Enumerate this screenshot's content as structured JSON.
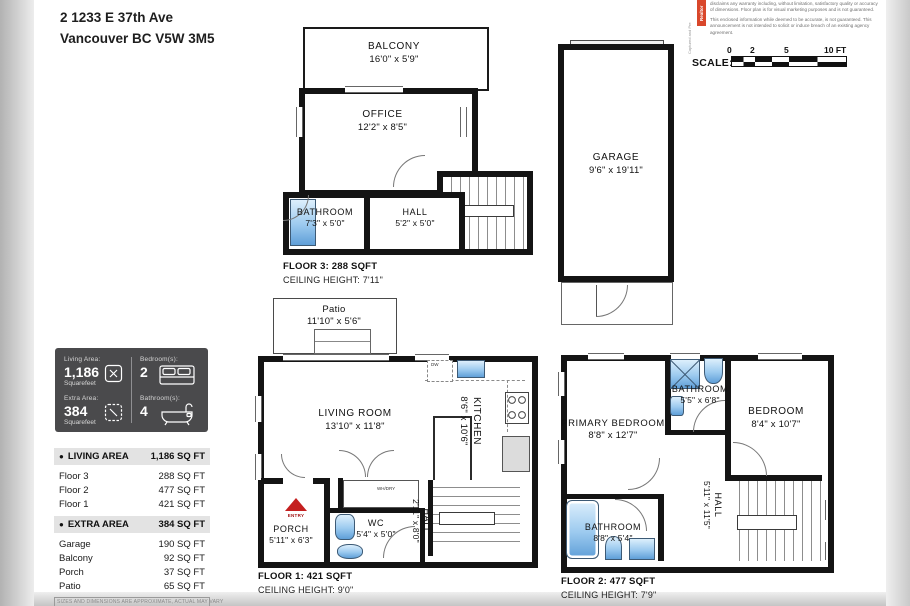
{
  "address": {
    "line1": "2 1233 E 37th Ave",
    "line2": "Vancouver BC V5W 3M5"
  },
  "branding": {
    "side_caption": "Captured and Pre",
    "badge": "Realtor"
  },
  "disclaimer": {
    "p1": "disclaims any warranty including, without limitation, satisfactory quality or accuracy of dimensions. Floor plan is for visual marketing purposes and is not guaranteed.",
    "p2": "This enclosed information while deemed to be accurate, is not guaranteed. This announcement is not intended to solicit or induce breach of an existing agency agreement."
  },
  "scale": {
    "label": "SCALE:",
    "t0": "0",
    "t2": "2",
    "t5": "5",
    "t10": "10 FT"
  },
  "stats": {
    "living": {
      "label": "Living Area:",
      "value": "1,186",
      "unit": "Squarefeet"
    },
    "extra": {
      "label": "Extra Area:",
      "value": "384",
      "unit": "Squarefeet"
    },
    "bedrooms": {
      "label": "Bedroom(s):",
      "value": "2"
    },
    "bathrooms": {
      "label": "Bathroom(s):",
      "value": "4"
    }
  },
  "area_table": {
    "living": {
      "title": "LIVING AREA",
      "total": "1,186 SQ FT",
      "rows": [
        {
          "label": "Floor 3",
          "value": "288 SQ FT"
        },
        {
          "label": "Floor 2",
          "value": "477 SQ FT"
        },
        {
          "label": "Floor 1",
          "value": "421 SQ FT"
        }
      ]
    },
    "extra": {
      "title": "EXTRA AREA",
      "total": "384 SQ FT",
      "rows": [
        {
          "label": "Garage",
          "value": "190 SQ FT"
        },
        {
          "label": "Balcony",
          "value": "92 SQ FT"
        },
        {
          "label": "Porch",
          "value": "37 SQ FT"
        },
        {
          "label": "Patio",
          "value": "65 SQ FT"
        }
      ]
    },
    "footnote": "SIZES AND DIMENSIONS ARE APPROXIMATE, ACTUAL MAY VARY"
  },
  "floor3": {
    "caption": "FLOOR 3: 288 SQFT",
    "ceiling": "CEILING HEIGHT: 7'11\"",
    "balcony": {
      "name": "BALCONY",
      "dims": "16'0\" x 5'9\""
    },
    "office": {
      "name": "OFFICE",
      "dims": "12'2\" x 8'5\""
    },
    "bathroom": {
      "name": "BATHROOM",
      "dims": "7'3\" x 5'0\""
    },
    "hall": {
      "name": "HALL",
      "dims": "5'2\" x 5'0\""
    }
  },
  "garage": {
    "room": {
      "name": "GARAGE",
      "dims": "9'6\" x 19'11\""
    }
  },
  "floor1": {
    "caption": "FLOOR 1: 421 SQFT",
    "ceiling": "CEILING HEIGHT: 9'0\"",
    "patio": {
      "name": "Patio",
      "dims": "11'10\" x 5'6\""
    },
    "living": {
      "name": "LIVING ROOM",
      "dims": "13'10\" x 11'8\""
    },
    "kitchen": {
      "name": "KITCHEN",
      "dims": "8'6\" x 10'6\""
    },
    "porch": {
      "name": "PORCH",
      "dims": "5'11\" x 6'3\""
    },
    "wc": {
      "name": "WC",
      "dims": "5'4\" x 5'0\""
    },
    "hall": {
      "name": "HALL",
      "dims": "2'11\" x 8'0\""
    },
    "whdry": "WH/DRY",
    "entry": "ENTRY",
    "dw": "DW"
  },
  "floor2": {
    "caption": "FLOOR 2: 477 SQFT",
    "ceiling": "CEILING HEIGHT: 7'9\"",
    "primary": {
      "name": "PRIMARY BEDROOM",
      "dims": "8'8\" x 12'7\""
    },
    "bath_top": {
      "name": "BATHROOM",
      "dims": "5'5\" x 6'8\""
    },
    "bedroom": {
      "name": "BEDROOM",
      "dims": "8'4\" x 10'7\""
    },
    "bath_bottom": {
      "name": "BATHROOM",
      "dims": "8'8\" x 5'4\""
    },
    "hall": {
      "name": "HALL",
      "dims": "5'11\" x 11'5\""
    }
  },
  "colors": {
    "wall": "#141414",
    "fixture_blue": "#7db8e8",
    "badge_red": "#d9472b",
    "entry_red": "#c41f1f"
  }
}
